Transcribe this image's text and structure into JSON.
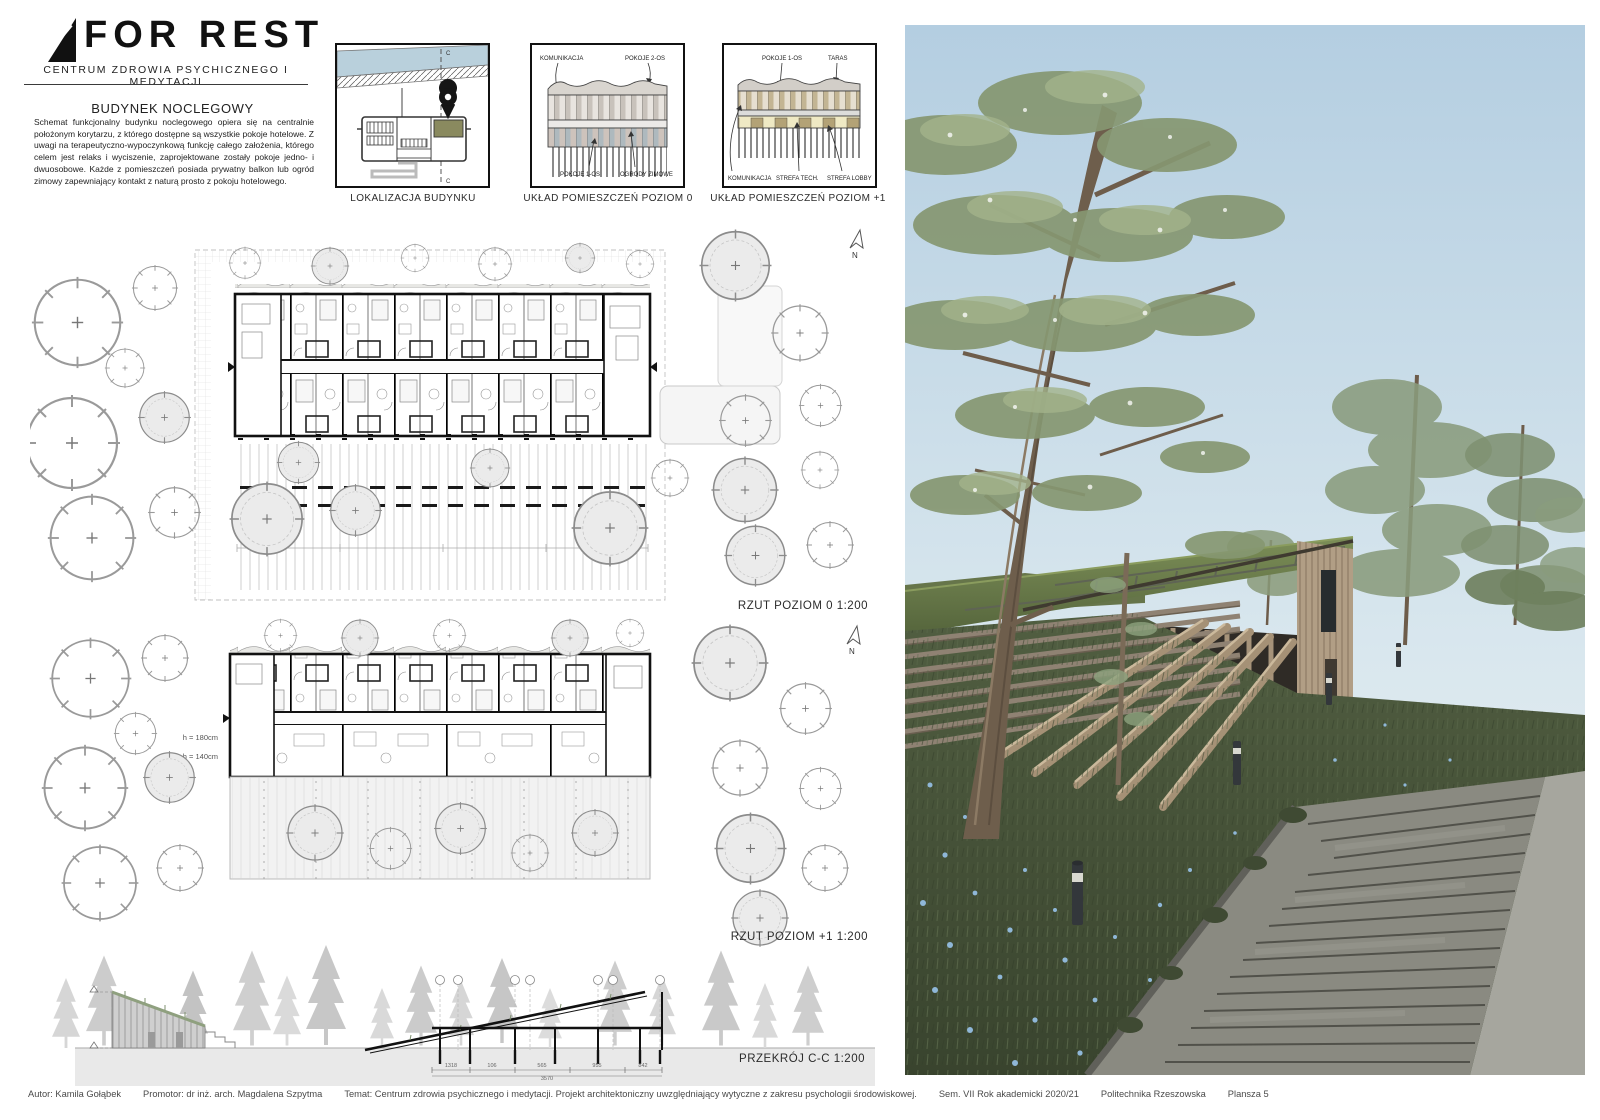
{
  "header": {
    "logo_title": "FOR REST",
    "logo_subtitle": "CENTRUM ZDROWIA PSYCHICZNEGO I MEDYTACJI"
  },
  "intro": {
    "title": "BUDYNEK NOCLEGOWY",
    "body": "Schemat funkcjonalny budynku noclegowego opiera się na centralnie położonym korytarzu, z którego dostępne są wszystkie pokoje hotelowe. Z uwagi na terapeutyczno-wypoczynkową funkcję całego założenia, którego celem jest relaks i wyciszenie, zaprojektowane zostały pokoje jedno- i dwuosobowe. Każde z pomieszczeń posiada prywatny balkon lub ogród zimowy zapewniający kontakt z naturą prosto z pokoju hotelowego."
  },
  "diagrams": {
    "d1": {
      "caption": "LOKALIZACJA BUDYNKU",
      "section_mark": "C"
    },
    "d2": {
      "caption": "UKŁAD POMIESZCZEŃ POZIOM 0",
      "label_komunikacja": "KOMUNIKACJA",
      "label_pokoje2": "POKOJE 2-OS",
      "label_pokoje1": "POKOJE 1-OS",
      "label_ogrody": "OGRODY ZIMOWE"
    },
    "d3": {
      "caption": "UKŁAD POMIESZCZEŃ POZIOM +1",
      "label_pokoje1": "POKOJE 1-OS",
      "label_taras": "TARAS",
      "label_komunikacja": "KOMUNIKACJA",
      "label_strefa_tech": "STREFA TECH.",
      "label_strefa_lobby": "STREFA LOBBY"
    }
  },
  "plans": {
    "p0": {
      "caption": "RZUT POZIOM 0   1:200",
      "north": "N"
    },
    "p1": {
      "caption": "RZUT POZIOM +1   1:200",
      "north": "N",
      "h1": "h = 180cm",
      "h2": "h = 140cm"
    }
  },
  "section_drawing": {
    "caption": "PRZEKRÓJ C-C  1:200",
    "dims": [
      "1318",
      "106",
      "565",
      "955",
      "842"
    ],
    "total": "3570"
  },
  "footer": {
    "autor": "Autor: Kamila Gołąbek",
    "promotor": "Promotor: dr inż. arch. Magdalena Szpytma",
    "temat": "Temat: Centrum zdrowia psychicznego i medytacji. Projekt architektoniczny uwzględniający wytyczne z zakresu psychologii środowiskowej.",
    "sem": "Sem. VII  Rok akademicki 2020/21",
    "uczelnia": "Politechnika Rzeszowska",
    "plansza": "Plansza 5"
  },
  "colors": {
    "accent_olive": "#8a8a5f",
    "water_blue": "#b9d0dc",
    "diagram_tan": "#b3a276",
    "diagram_cream": "#efe9c4",
    "sky": "#b7cfe0",
    "roof_grass": "#66754a",
    "meadow_green": "#46523a",
    "wood": "#b19e85",
    "flower_blue": "#8fb7d8"
  }
}
